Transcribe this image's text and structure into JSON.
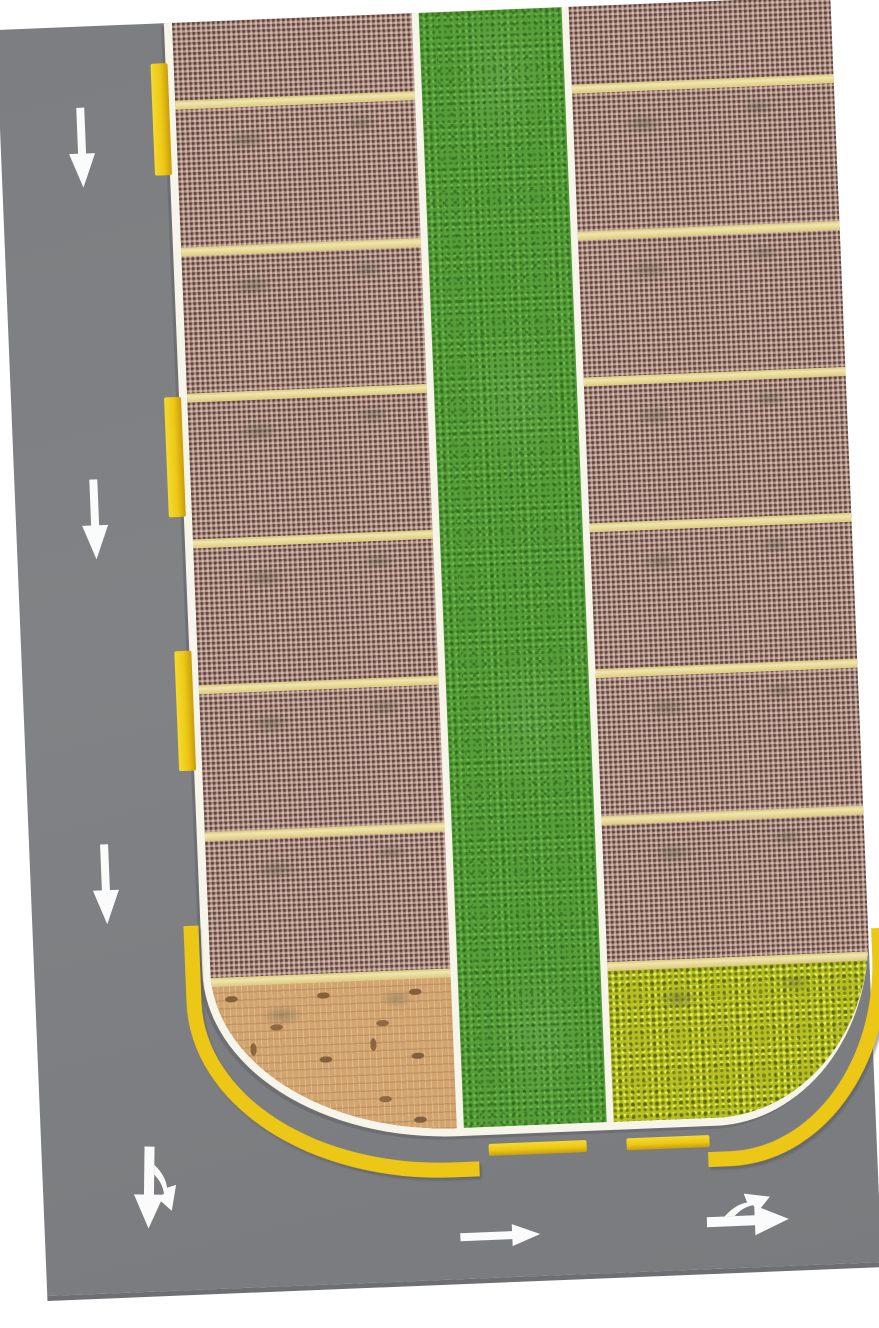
{
  "scene": {
    "description": "Top-down printed model parking-lot mat, slightly tilted, on a white background. A grey road runs along the left side and across the bottom; two columns of parking stalls flank a central grass median; the lot's lower-left corner is brick pavement and the lower-right corner is a yellow flower bed; white boundary lines with yellow curb markings surround the lot.",
    "tilt_deg": -2.32,
    "colors": {
      "background": "#ffffff",
      "road": "#808285",
      "road_edge": "#6d6f72",
      "white_line": "#f7f4ea",
      "curb_yellow": "#edc716",
      "stall_line_cream": "#f1e6ad",
      "paver_base": "#b29288",
      "grass_base": "#559d38",
      "brick_base": "#d2a470",
      "flower_base": "#b6be20",
      "arrow_white": "#fbfbfb"
    },
    "road": {
      "left_lane_arrow_count": 3,
      "left_lane_arrow_direction": "down",
      "junction_fork_arrow_directions": [
        "down",
        "down-right"
      ],
      "bottom_straight_arrow_direction": "right",
      "bottom_fork_arrow_directions": [
        "right",
        "up-right"
      ]
    },
    "markings": {
      "down_arrows": [
        {
          "x": 66,
          "y": 81
        },
        {
          "x": 64,
          "y": 453
        },
        {
          "x": 60,
          "y": 818
        }
      ]
    },
    "curbs": {
      "left_dashes": [
        {
          "y": 40,
          "h": 112
        },
        {
          "y": 374,
          "h": 120
        },
        {
          "y": 628,
          "h": 120
        }
      ],
      "bottom_dashes": [
        {
          "x": 447,
          "w": 98
        },
        {
          "x": 585,
          "w": 83
        }
      ],
      "corner_bands": [
        "bottom-left",
        "bottom-right"
      ]
    },
    "parking": {
      "columns": [
        "left",
        "right"
      ],
      "stall_rows_per_column": 7,
      "separator_tops": [
        78,
        225,
        371,
        517,
        663,
        810,
        956
      ],
      "median": "grass strip",
      "landscape_left": "brick pavement corner",
      "landscape_right": "yellow flower bed corner"
    }
  }
}
